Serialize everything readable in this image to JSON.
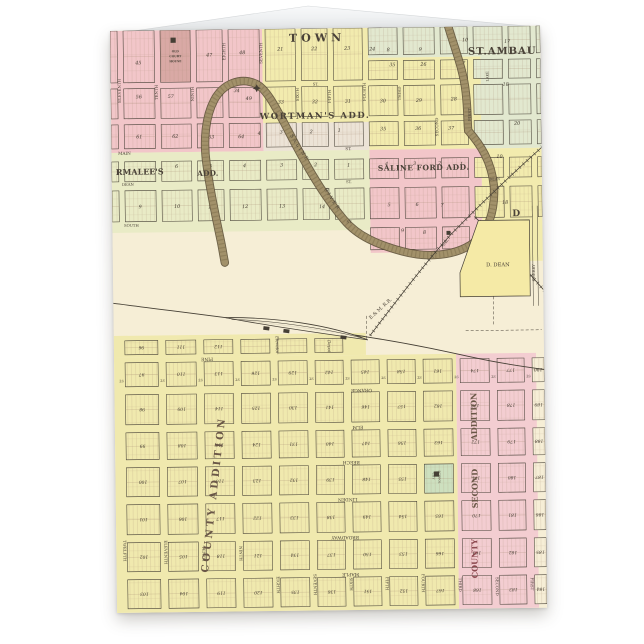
{
  "scene": {
    "background": "#ffffff",
    "description": "standing greeting card with antique plat map print"
  },
  "card": {
    "x": 110,
    "y": 31,
    "width": 430,
    "height": 582,
    "back_flap_points": "113,34 308,6 537,27 537,34"
  },
  "map": {
    "palette": {
      "pink": "#f2c6c9",
      "yellow": "#f2ebae",
      "green": "#e2e8cf",
      "pale": "#ece3d6",
      "parmalee": "#e9ebc6",
      "cream": "#f6eed6",
      "lower_yellow": "#f0e9ae",
      "lower_pink": "#f3cdd1",
      "school_green": "#cde0bf",
      "courthouse": "#d9a9a5",
      "ddean_yellow": "#f5eaa6",
      "river": "#a2916a",
      "river_edge": "#5e5138",
      "river_texture": "#70603f",
      "ink": "#453f35",
      "number_ink": "#3f382e",
      "label_ink": "#4a4238",
      "lot_line": "#a58a72",
      "add_ink": "#6a5747",
      "red_label": "#8d4a50"
    },
    "regions": [
      {
        "x": 0,
        "y": 0,
        "w": 152,
        "h": 122,
        "f": "pink"
      },
      {
        "x": 152,
        "y": 94,
        "w": 106,
        "h": 28,
        "f": "pale"
      },
      {
        "x": 152,
        "y": 0,
        "w": 106,
        "h": 94,
        "f": "yellow"
      },
      {
        "x": 258,
        "y": 0,
        "w": 172,
        "h": 30,
        "f": "green"
      },
      {
        "x": 370,
        "y": 30,
        "w": 60,
        "h": 92,
        "f": "green"
      },
      {
        "x": 258,
        "y": 30,
        "w": 112,
        "h": 92,
        "f": "yellow"
      },
      {
        "x": 0,
        "y": 122,
        "w": 258,
        "h": 80,
        "f": "parmalee"
      },
      {
        "x": 258,
        "y": 122,
        "w": 112,
        "h": 103,
        "f": "pink"
      },
      {
        "x": 370,
        "y": 122,
        "w": 60,
        "h": 113,
        "f": "yellow"
      },
      {
        "x": 0,
        "y": 305,
        "w": 252,
        "h": 22,
        "f": "lower_yellow"
      },
      {
        "x": 0,
        "y": 327,
        "w": 342,
        "h": 255,
        "f": "lower_yellow"
      },
      {
        "x": 342,
        "y": 327,
        "w": 80,
        "h": 255,
        "f": "lower_pink"
      }
    ],
    "grids": [
      {
        "name": "upper-town-grid",
        "cols": [
          [
            0,
            7
          ],
          [
            13,
            44
          ],
          [
            50,
            80
          ],
          [
            86,
            112
          ],
          [
            118,
            149
          ],
          [
            155,
            185
          ],
          [
            191,
            217
          ],
          [
            223,
            252
          ],
          [
            258,
            287
          ],
          [
            293,
            324
          ],
          [
            330,
            357
          ],
          [
            363,
            392
          ],
          [
            398,
            420
          ],
          [
            426,
            430
          ]
        ],
        "rows": [
          [
            0,
            52
          ],
          [
            58,
            88
          ],
          [
            94,
            118
          ],
          [
            131,
            151
          ],
          [
            160,
            191
          ],
          [
            200,
            222
          ]
        ],
        "row_limits": [
          null,
          null,
          null,
          null,
          null,
          [
            258,
            375
          ]
        ],
        "subsplit": {
          "row": 0,
          "from_x": 258,
          "splits": [
            [
              0,
              27
            ],
            [
              33,
              52
            ]
          ]
        }
      },
      {
        "name": "lower-town-grid",
        "cols": [
          [
            11,
            44
          ],
          [
            52,
            82
          ],
          [
            90,
            119
          ],
          [
            127,
            156
          ],
          [
            164,
            193
          ],
          [
            201,
            229
          ],
          [
            237,
            265
          ],
          [
            273,
            301
          ],
          [
            309,
            338
          ],
          [
            346,
            375
          ],
          [
            383,
            410
          ],
          [
            418,
            430
          ]
        ],
        "rows": [
          [
            310,
            324
          ],
          [
            332,
            356
          ],
          [
            364,
            394
          ],
          [
            402,
            429
          ],
          [
            437,
            466
          ],
          [
            474,
            504
          ],
          [
            512,
            541
          ],
          [
            549,
            578
          ]
        ],
        "row_limits": [
          [
            0,
            252
          ],
          null,
          null,
          null,
          null,
          null,
          null,
          null
        ],
        "number_rot": 180
      }
    ],
    "special_cells": [
      {
        "grid": 0,
        "col": 2,
        "row": 0,
        "fill": "courthouse",
        "square": [
          63,
          10
        ],
        "texts": [
          {
            "t": "OLD",
            "x": 65,
            "y": 22
          },
          {
            "t": "COURT",
            "x": 65,
            "y": 27
          },
          {
            "t": "HOUSE",
            "x": 65,
            "y": 32
          }
        ]
      },
      {
        "grid": 1,
        "col": 8,
        "row": 4,
        "fill": "school_green",
        "square": [
          321,
          447
        ],
        "texts": []
      }
    ],
    "upper_numbers": [
      [
        28,
        32,
        "45"
      ],
      [
        99,
        25,
        "47"
      ],
      [
        132,
        23,
        "48"
      ],
      [
        170,
        20,
        "21"
      ],
      [
        204,
        20,
        "22"
      ],
      [
        237,
        20,
        "23"
      ],
      [
        262,
        21,
        "24"
      ],
      [
        278,
        22,
        "8"
      ],
      [
        310,
        22,
        "9"
      ],
      [
        355,
        13,
        "10"
      ],
      [
        397,
        15,
        "17"
      ],
      [
        282,
        37,
        "35"
      ],
      [
        313,
        37,
        "26"
      ],
      [
        352,
        36,
        "27"
      ],
      [
        28,
        66,
        "56"
      ],
      [
        60,
        66,
        "57"
      ],
      [
        105,
        68,
        "50"
      ],
      [
        138,
        69,
        "49"
      ],
      [
        126,
        61,
        "34"
      ],
      [
        170,
        73,
        "33"
      ],
      [
        204,
        73,
        "32"
      ],
      [
        237,
        73,
        "31"
      ],
      [
        272,
        73,
        "30"
      ],
      [
        308,
        73,
        "29"
      ],
      [
        343,
        72,
        "28"
      ],
      [
        395,
        58,
        "18"
      ],
      [
        406,
        97,
        "20"
      ],
      [
        28,
        106,
        "61"
      ],
      [
        64,
        106,
        "62"
      ],
      [
        100,
        107,
        "63"
      ],
      [
        130,
        107,
        "64"
      ],
      [
        148,
        104,
        "4"
      ],
      [
        170,
        103,
        "3"
      ],
      [
        200,
        103,
        "2"
      ],
      [
        228,
        102,
        "1"
      ],
      [
        272,
        101,
        "35"
      ],
      [
        307,
        101,
        "36"
      ],
      [
        340,
        101,
        "37"
      ],
      [
        65,
        136,
        "6"
      ],
      [
        99,
        136,
        "5"
      ],
      [
        133,
        136,
        "4"
      ],
      [
        170,
        136,
        "3"
      ],
      [
        204,
        136,
        "2"
      ],
      [
        237,
        137,
        "1"
      ],
      [
        275,
        136,
        "4"
      ],
      [
        303,
        136,
        "3"
      ],
      [
        328,
        136,
        "2"
      ],
      [
        350,
        137,
        "1"
      ],
      [
        388,
        130,
        "10"
      ],
      [
        393,
        176,
        "18"
      ],
      [
        28,
        176,
        "9"
      ],
      [
        65,
        176,
        "10"
      ],
      [
        99,
        177,
        "11"
      ],
      [
        133,
        177,
        "12"
      ],
      [
        170,
        177,
        "13"
      ],
      [
        210,
        178,
        "14"
      ],
      [
        277,
        177,
        "5"
      ],
      [
        305,
        177,
        "6"
      ],
      [
        330,
        178,
        "7"
      ],
      [
        290,
        203,
        "9"
      ],
      [
        312,
        205,
        "8"
      ]
    ],
    "lower_numbers": [
      [
        96,
        111,
        112
      ],
      [
        97,
        110,
        113,
        126,
        129,
        142,
        145,
        158,
        161,
        174,
        177,
        190
      ],
      [
        98,
        109,
        114,
        125,
        130,
        141,
        146,
        157,
        162,
        173,
        178,
        189
      ],
      [
        99,
        108,
        115,
        124,
        131,
        140,
        147,
        156,
        163,
        172,
        179,
        188
      ],
      [
        100,
        107,
        116,
        123,
        132,
        139,
        148,
        155,
        164,
        171,
        180,
        187
      ],
      [
        101,
        106,
        117,
        122,
        133,
        138,
        149,
        154,
        165,
        170,
        181,
        186
      ],
      [
        102,
        105,
        118,
        121,
        134,
        137,
        150,
        153,
        166,
        169,
        182,
        185
      ],
      [
        103,
        104,
        119,
        120,
        135,
        136,
        151,
        152,
        167,
        168,
        183,
        184
      ]
    ],
    "labels": [
      {
        "t": "TOWN",
        "x": 207,
        "y": 13,
        "s": 11,
        "b": 1,
        "ls": 4
      },
      {
        "t": "ST.AMBAU",
        "x": 392,
        "y": 28,
        "s": 10,
        "b": 1,
        "ls": 1
      },
      {
        "t": "WORTMAN'S ADD.",
        "x": 204,
        "y": 90,
        "s": 8.5,
        "b": 1,
        "ls": 1.5
      },
      {
        "t": "SALINE FORD ADD.",
        "x": 312,
        "y": 143,
        "s": 7.5,
        "b": 1,
        "ls": 0.5
      },
      {
        "t": "RMALEE'S",
        "x": 28,
        "y": 144,
        "s": 8,
        "b": 1
      },
      {
        "t": "ADD.",
        "x": 96,
        "y": 146,
        "s": 7.5,
        "b": 1
      },
      {
        "t": "MAIN",
        "x": 13,
        "y": 124,
        "s": 4.2
      },
      {
        "t": "ST.",
        "x": 237,
        "y": 122,
        "s": 4
      },
      {
        "t": "DEAN",
        "x": 16,
        "y": 155,
        "s": 3.8
      },
      {
        "t": "ST.",
        "x": 237,
        "y": 155,
        "s": 3.8
      },
      {
        "t": "SOUTH",
        "x": 19,
        "y": 196,
        "s": 3.8
      },
      {
        "t": "ST.",
        "x": 237,
        "y": 195,
        "s": 3.8
      },
      {
        "t": "ST.",
        "x": 205,
        "y": 57,
        "s": 3.8
      },
      {
        "t": "DEAN",
        "x": 383,
        "y": 154,
        "s": 3.4
      },
      {
        "t": "D",
        "x": 404,
        "y": 190,
        "s": 9,
        "b": 1
      },
      {
        "t": "D. DEAN",
        "x": 385,
        "y": 240,
        "s": 5.2
      },
      {
        "t": "CHERRY",
        "x": 422,
        "y": 247,
        "s": 3.8,
        "r": -90
      },
      {
        "t": "MILL",
        "x": 333,
        "y": 217,
        "s": 3.6,
        "r": -48
      },
      {
        "t": "E.& M. R.R.",
        "x": 268,
        "y": 282,
        "s": 4.8,
        "r": -42
      },
      {
        "t": "Elevator",
        "x": 162,
        "y": 316,
        "s": 4.2,
        "r": 90,
        "i": 1
      },
      {
        "t": "Depot",
        "x": 214,
        "y": 318,
        "s": 4.2,
        "r": 90,
        "i": 1
      },
      {
        "t": "SALINE",
        "x": 187,
        "y": 120,
        "s": 4.8,
        "r": 58,
        "ls": 2
      },
      {
        "t": "RIVER",
        "x": 219,
        "y": 172,
        "s": 4.8,
        "r": 58,
        "ls": 2
      },
      {
        "t": "LAKE",
        "x": 378,
        "y": 50,
        "s": 3.6,
        "r": -90
      },
      {
        "t": "ELEVENTH",
        "x": 10,
        "y": 60,
        "s": 4,
        "r": -90
      },
      {
        "t": "TENTH",
        "x": 47,
        "y": 62,
        "s": 4,
        "r": -90
      },
      {
        "t": "NINTH",
        "x": 83,
        "y": 64,
        "s": 4,
        "r": -90
      },
      {
        "t": "EIGHTH",
        "x": 115,
        "y": 22,
        "s": 4,
        "r": -90
      },
      {
        "t": "SEVENTH",
        "x": 152,
        "y": 24,
        "s": 4,
        "r": -90
      },
      {
        "t": "SIXTH",
        "x": 188,
        "y": 66,
        "s": 4,
        "r": -90
      },
      {
        "t": "FIFTH",
        "x": 220,
        "y": 68,
        "s": 4,
        "r": -90
      },
      {
        "t": "FOURTH",
        "x": 255,
        "y": 64,
        "s": 4,
        "r": -90
      },
      {
        "t": "THIRD",
        "x": 290,
        "y": 66,
        "s": 4,
        "r": -90
      },
      {
        "t": "SECOND",
        "x": 327,
        "y": 100,
        "s": 4,
        "r": -90
      },
      {
        "t": "FIRST",
        "x": 360,
        "y": 88,
        "s": 4,
        "r": -90
      },
      {
        "t": "TWELFTH",
        "x": 7,
        "y": 520,
        "s": 4,
        "r": 90
      },
      {
        "t": "ELEVENTH",
        "x": 48,
        "y": 522,
        "s": 4,
        "r": 90
      },
      {
        "t": "TENTH",
        "x": 86,
        "y": 524,
        "s": 4,
        "r": 90
      },
      {
        "t": "NINTH",
        "x": 123,
        "y": 524,
        "s": 4,
        "r": 90
      },
      {
        "t": "EIGHTH",
        "x": 160,
        "y": 556,
        "s": 4,
        "r": 90
      },
      {
        "t": "SEVENTH",
        "x": 197,
        "y": 556,
        "s": 4,
        "r": 90
      },
      {
        "t": "SIXTH",
        "x": 233,
        "y": 556,
        "s": 4,
        "r": 90
      },
      {
        "t": "FIFTH",
        "x": 269,
        "y": 556,
        "s": 4,
        "r": 90
      },
      {
        "t": "FOURTH",
        "x": 305,
        "y": 556,
        "s": 4,
        "r": 90
      },
      {
        "t": "THIRD",
        "x": 342,
        "y": 558,
        "s": 4,
        "r": 90
      },
      {
        "t": "SECOND",
        "x": 379,
        "y": 560,
        "s": 4,
        "r": 90
      },
      {
        "t": "FIRST",
        "x": 414,
        "y": 558,
        "s": 4,
        "r": 90
      },
      {
        "t": "PINE",
        "x": 93,
        "y": 328,
        "s": 4.5,
        "r": 180
      },
      {
        "t": "ORANGE",
        "x": 247,
        "y": 361,
        "s": 4.5,
        "r": 180
      },
      {
        "t": "ELM",
        "x": 243,
        "y": 398,
        "s": 4.5,
        "r": 180
      },
      {
        "t": "BEECH",
        "x": 236,
        "y": 433,
        "s": 4.5,
        "r": 180
      },
      {
        "t": "LINDEN",
        "x": 232,
        "y": 470,
        "s": 4.5,
        "r": 180
      },
      {
        "t": "BROADWAY",
        "x": 229,
        "y": 508,
        "s": 4.5,
        "r": 180
      },
      {
        "t": "MAPLE",
        "x": 234,
        "y": 545,
        "s": 4.5,
        "r": 180
      },
      {
        "t": "COUNTY ADDITION",
        "x": 101,
        "y": 465,
        "s": 10,
        "r": -83,
        "b": 1,
        "ls": 3,
        "c": "add_ink"
      },
      {
        "t": "ADDITION",
        "x": 362,
        "y": 390,
        "s": 8,
        "r": -90,
        "b": 1,
        "c": "add_ink"
      },
      {
        "t": "SECOND",
        "x": 362,
        "y": 462,
        "s": 8,
        "r": -90,
        "b": 1,
        "c": "add_ink"
      },
      {
        "t": "COUNTY",
        "x": 361,
        "y": 532,
        "s": 8,
        "r": -90,
        "b": 1,
        "c": "red_label"
      },
      {
        "t": "CITY",
        "x": 317,
        "y": 449,
        "s": 2.8,
        "r": 90
      },
      {
        "t": "SCHOOL",
        "x": 323,
        "y": 450,
        "s": 2.8,
        "r": 90
      }
    ],
    "lower_street_st_labels": {
      "xs": [
        7,
        48,
        86,
        123,
        160,
        197,
        233,
        269,
        305,
        342,
        379,
        414
      ],
      "y": 349,
      "t": "ST."
    },
    "paths": {
      "river": "M337,-5 C343,18 353,42 355,66 C357,85 356,94 357,104 C369,118 380,135 382,160 C383,185 376,205 360,217 C342,229 315,231 290,224 C265,217 245,208 232,192 C208,163 190,128 173,94 C162,73 155,60 146,55 C130,47 112,54 103,71 C94,88 92,112 95,135 C98,160 103,185 108,210 C110,220 111,228 112,233",
      "rail_b": "M-2,272 C90,285 200,300 253,309 C300,317 330,324 360,331 C390,338 412,341 432,344",
      "rail_a": "M432,120 C400,148 362,184 338,208 C312,236 278,280 256,308",
      "rail_branch": "M362,190 C388,214 410,240 432,266",
      "siding_top": "M112,288 C160,288 215,296 254,312",
      "siding_bottom": "M112,288 C150,296 208,305 254,312",
      "siding_inner": "M118,290 C158,291 212,300 248,310",
      "ddean_parcel": "M347,246 L366,194 L417,194 L417,270 L347,270 Z"
    },
    "cherry_lines": [
      [
        420,
        180,
        420,
        280
      ],
      [
        425,
        180,
        425,
        280
      ]
    ],
    "dashed_lines": [
      [
        253,
        288,
        253,
        312
      ],
      [
        380,
        230,
        380,
        300
      ],
      [
        352,
        304,
        428,
        304
      ]
    ],
    "buildings": [
      [
        150,
        297
      ],
      [
        170,
        300
      ],
      [
        227,
        307
      ]
    ],
    "mill_square": [
      334,
      204
    ],
    "star": [
      146,
      59
    ]
  }
}
